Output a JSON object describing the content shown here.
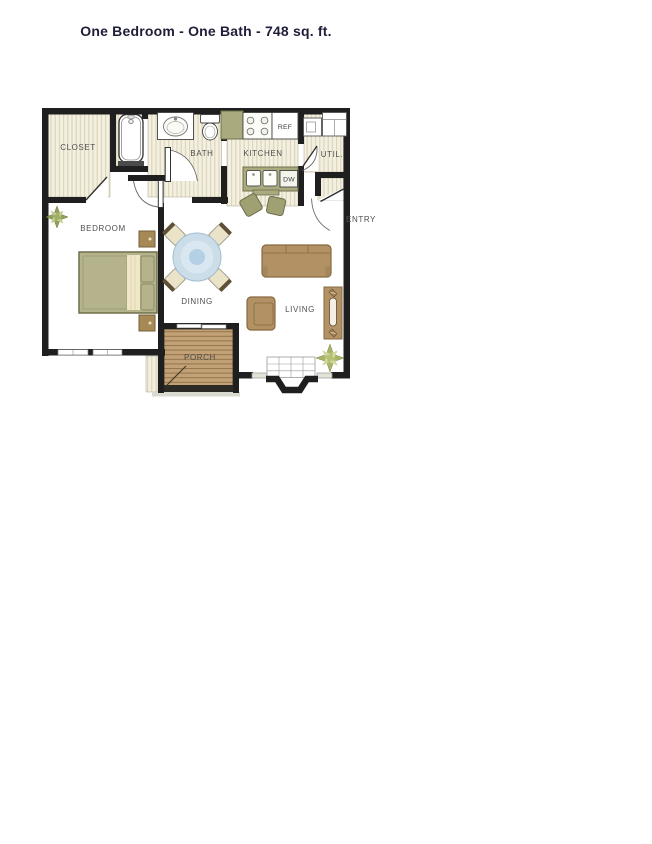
{
  "title": {
    "text": "One Bedroom - One Bath - 748 sq. ft."
  },
  "floor_plan": {
    "room_labels": {
      "closet": "CLOSET",
      "bath": "BATH",
      "kitchen": "KITCHEN",
      "utility": "UTIL.",
      "entry": "ENTRY",
      "bedroom": "BEDROOM",
      "dining": "DINING",
      "living": "LIVING",
      "porch": "PORCH"
    },
    "appliance_labels": {
      "refrigerator": "REF",
      "dishwasher": "DW"
    },
    "fixtures": [
      "bathtub",
      "vanity-sink",
      "toilet",
      "stove",
      "refrigerator",
      "double-sink",
      "dishwasher",
      "washer-dryer",
      "bed",
      "nightstand",
      "dining-table",
      "dining-chair",
      "bar-stool",
      "sofa",
      "armchair",
      "console-table",
      "fireplace",
      "hearth",
      "sliding-door",
      "window",
      "plant",
      "wood-deck"
    ],
    "colors": {
      "wall": "#1f1f1f",
      "floor_base": "#f4f0e1",
      "floor_stripe": "#dcd5ba",
      "wood_deck": "#c2a177",
      "furniture_tan": "#b29265",
      "furniture_green": "#a9aa7e",
      "bed_green": "#b4b38b",
      "pillow_cream": "#efe7c7",
      "table_blue": "#cbdde9",
      "title_text": "#1e1e38",
      "label_text": "#4f4f4f"
    }
  }
}
